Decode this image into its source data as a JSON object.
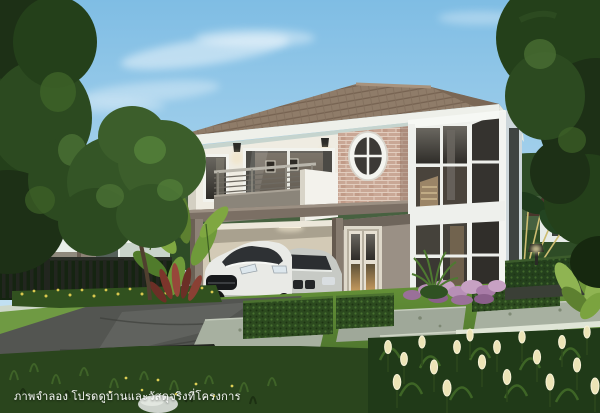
{
  "image": {
    "type": "architectural-rendering",
    "caption": "ภาพจำลอง โปรดดูบ้านและวัสดุจริงที่โครงการ",
    "scene": {
      "setting": "suburban housing-project rendering, daytime, clear blue sky",
      "main_subject": "two-story detached house with hip tile roof, balcony, oval window, stone accent wall, two-story stair bay window and carport",
      "vehicles": [
        "white sports coupe",
        "silver sedan"
      ],
      "landscaping": [
        "lawn",
        "trimmed boxwood hedges",
        "purple flower bed",
        "cream tulip bed",
        "stepping stones",
        "travelers palm",
        "banana plants",
        "garden trees",
        "yellow-flower hedge",
        "pebble bed"
      ],
      "background": [
        "neighboring two-story house",
        "dark slat fence",
        "hedge wall with garden lamp",
        "distant roof"
      ]
    }
  },
  "colors": {
    "sky_top": "#7fbde4",
    "sky_horizon": "#d9edf7",
    "cloud": "#ffffff",
    "roof_tile": "#8f7c69",
    "roof_side": "#7a6755",
    "fascia": "#eef0ea",
    "soffit": "#ccd5c9",
    "wall_upper": "#efece2",
    "stone_brick": "#c9a795",
    "slab_band": "#7b6f64",
    "wall_lower": "#9a9085",
    "carport_interior": "#d3cab6",
    "window_frame": "#f2f3ee",
    "window_glass": "#413f3a",
    "bay_side": "#cdd7da",
    "balcony_gray": "#8b857a",
    "balcony_white": "#f3f2ec",
    "door_glow": "#c89c5f",
    "car_white": "#e9eae6",
    "car_silver": "#c7cac5",
    "lawn_light": "#669338",
    "lawn_dark": "#3c6026",
    "hedge": "#2c4a1f",
    "foliage_dark": "#1d3016",
    "foliage_mid": "#345526",
    "foliage_light": "#5b8438",
    "banana_leaf": "#8fb452",
    "driveway": "#535551",
    "curb": "#cdd8c8",
    "paver": "#a7b0a0",
    "path_white": "#dfe5d6",
    "flower_purple": "#b78fb6",
    "flower_cream": "#ece4b6",
    "flower_yellow": "#d9c84e",
    "red_plant": "#7c352b",
    "fence_dark": "#22261f",
    "bg_house_wall": "#e9efe9",
    "bg_house_roof": "#8f897d",
    "bg_roof_right": "#4a362c",
    "caption": "#ffffff"
  }
}
